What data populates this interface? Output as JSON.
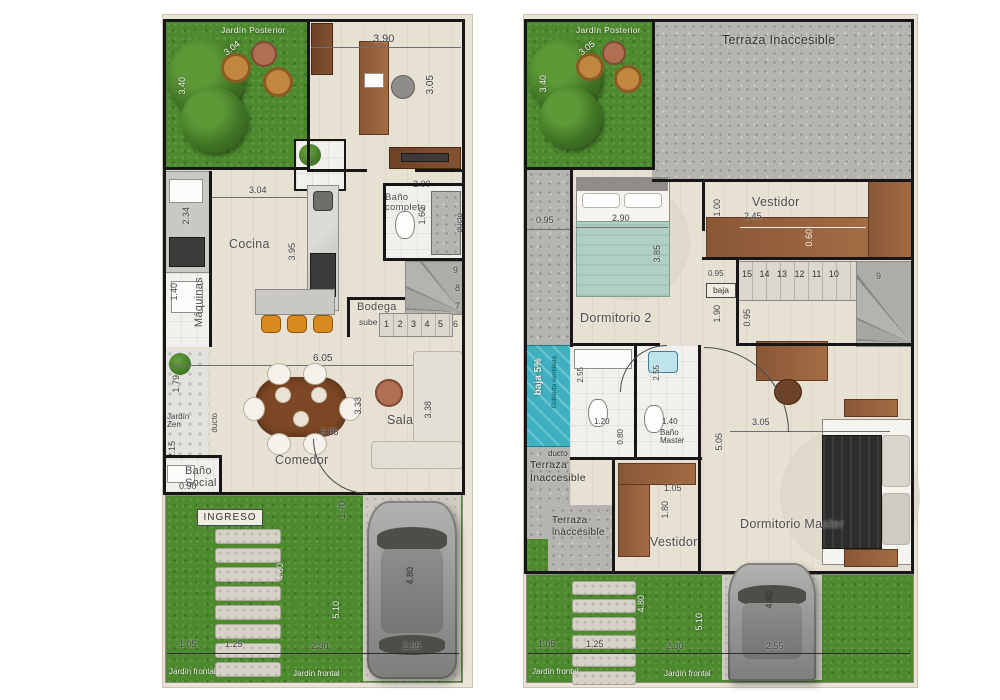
{
  "colors": {
    "grass": "#4c8a2d",
    "concrete": "#b6b4af",
    "teal_roof": "#3eb0bf",
    "wood": "#8a5737",
    "wall": "#161616",
    "sheet": "#eae4d8"
  },
  "left_plan": {
    "jardin_posterior": "Jardín Posterior",
    "dim_diag": "3.04",
    "dim_340": "3.40",
    "dim_390": "3.90",
    "dim_305": "3.05",
    "cocina": "Cocina",
    "dim_304": "3.04",
    "dim_395": "3.95",
    "dim_234": "2.34",
    "maquinas": "Máquinas",
    "dim_140": "1.40",
    "dim_179": "1.79",
    "jardin_zen": "Jardín Zen",
    "ducto_left": "ducto",
    "bano_completo": "Baño completo",
    "dim_200": "2.00",
    "dim_160": "1.60",
    "ducto_right": "ducto",
    "bodega": "Bodega",
    "sube": "sube",
    "stair_row": [
      "1",
      "2",
      "3",
      "4",
      "5"
    ],
    "stair_6": "6",
    "stair_7": "7",
    "stair_8": "8",
    "stair_9": "9",
    "dim_605": "6.05",
    "comedor": "Comedor",
    "dim_585": "5.85",
    "dim_333": "3.33",
    "sala": "Sala",
    "dim_338": "3.38",
    "bano_social": "Baño Social",
    "dim_215": "2.15",
    "dim_090": "0.90",
    "ingreso": "INGRESO",
    "dim_170": "1.70",
    "dim_480_garden": "4.80",
    "dim_510": "5.10",
    "dim_480_car": "4.80",
    "dim_105": "1.05",
    "dim_125": "1.25",
    "dim_230": "2.30",
    "dim_255": "2.55",
    "jardin_frontal_1": "Jardín frontal",
    "jardin_frontal_2": "Jardín frontal"
  },
  "right_plan": {
    "jardin_posterior": "Jardín Posterior",
    "dim_diag": "3.05",
    "dim_340": "3.40",
    "terraza_top": "Terraza Inaccesible",
    "dim_095_left": "0.95",
    "dormitorio2": "Dormitorio 2",
    "dim_290": "2.90",
    "dim_385": "3.85",
    "vestidor_top": "Vestidor",
    "dim_245": "2.45",
    "dim_100": "1.00",
    "dim_060": "0.60",
    "stair_row": [
      "15",
      "14",
      "13",
      "12",
      "11",
      "10"
    ],
    "stair_9": "9",
    "baja": "baja",
    "dim_095_stair": "0.95",
    "dim_190": "1.90",
    "dim_095_stair2": "0.95",
    "baja5": "baja 5%",
    "cubierta": "Cubierta ventilada",
    "ducto": "ducto",
    "dim_255_a": "2.55",
    "dim_255_b": "2.55",
    "dim_120": "1.20",
    "dim_080": "0.80",
    "dim_140": "1.40",
    "bano_master": "Baño Master",
    "terraza_mid": "Terraza Inaccesible",
    "terraza_low": "Terraza inaccesible",
    "vestidor_bottom": "Vestidor",
    "dim_105_v": "1.05",
    "dim_180": "1.80",
    "dormitorio_master": "Dormitorio Master",
    "dim_305": "3.05",
    "dim_505": "5.05",
    "dim_480_garden": "4.80",
    "dim_510": "5.10",
    "dim_480_car": "4.80",
    "dim_105": "1.05",
    "dim_125": "1.25",
    "dim_230": "2.30",
    "dim_255": "2.55",
    "jardin_frontal_1": "Jardín frontal",
    "jardin_frontal_2": "Jardín frontal"
  }
}
